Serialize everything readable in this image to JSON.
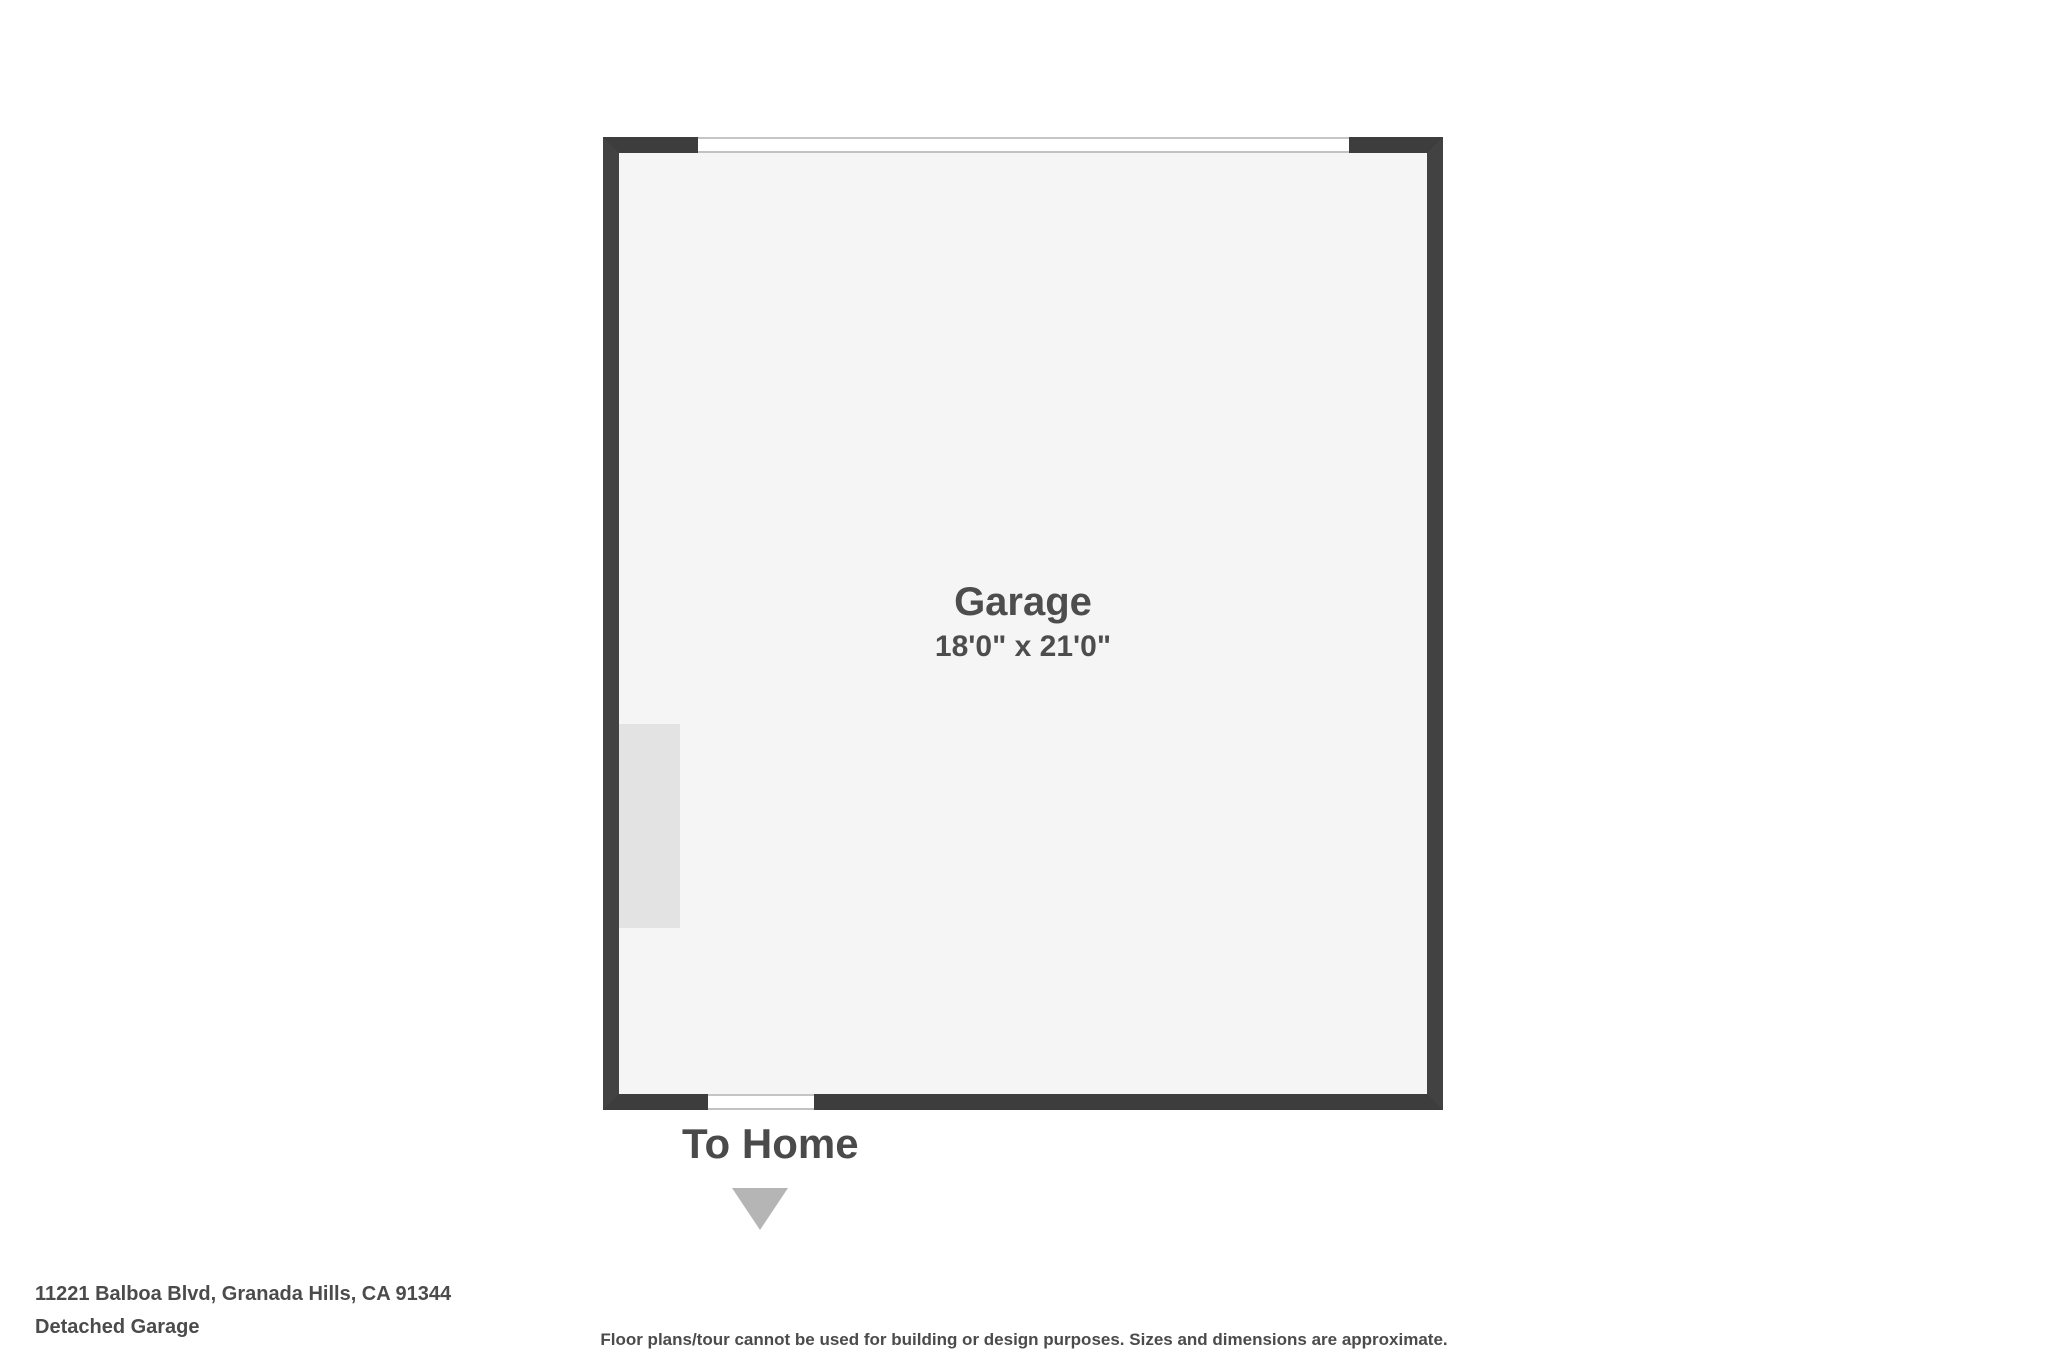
{
  "floorplan": {
    "room": {
      "name": "Garage",
      "dimensions": "18'0\" x 21'0\""
    },
    "to_home_label": "To Home",
    "colors": {
      "wall": "#3d3d3d",
      "interior": "#f5f5f6",
      "opening_trim": "#c5c5c5",
      "fixture": "#e3e3e4",
      "arrow": "#b5b5b5",
      "label_text": "#4d4d4d"
    }
  },
  "footer": {
    "address": "11221 Balboa Blvd, Granada Hills, CA 91344",
    "plan_title": "Detached Garage",
    "disclaimer": "Floor plans/tour cannot be used for building or design purposes. Sizes and dimensions are approximate."
  }
}
